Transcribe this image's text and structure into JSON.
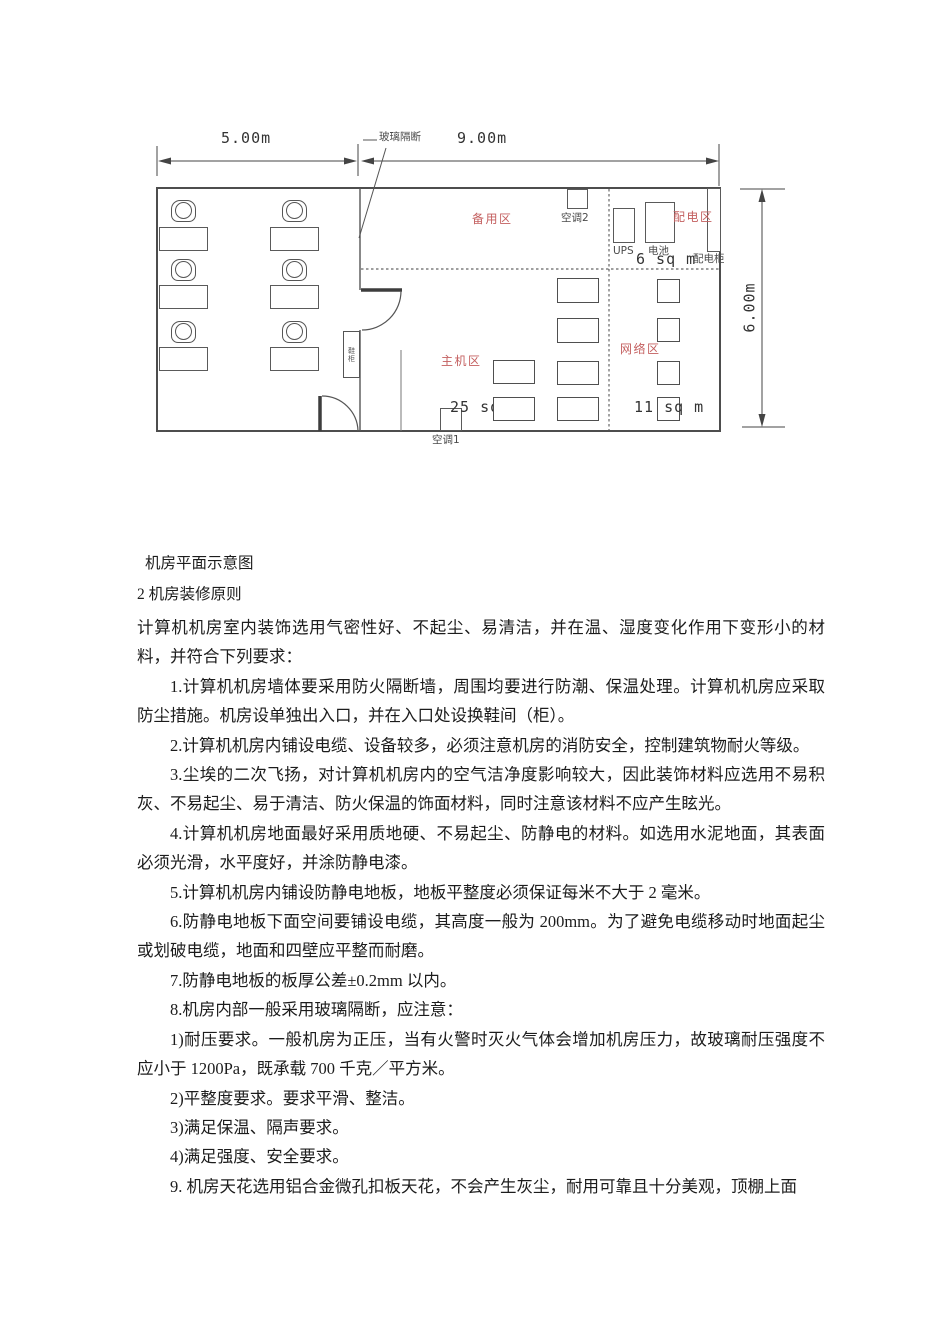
{
  "diagram": {
    "dimensions": {
      "left_width": "5.00m",
      "right_width": "9.00m",
      "height": "6.00m"
    },
    "zones": {
      "backup": "备用区",
      "power": "配电区",
      "main": "主机区",
      "network": "网络区"
    },
    "equipment": {
      "glass_partition": "玻璃隔断",
      "ac2": "空调2",
      "ac1": "空调1",
      "ups": "UPS",
      "battery": "电池",
      "power_cabinet": "配电柜",
      "shoe_cabinet": "鞋柜"
    },
    "areas": {
      "power": "6 sq m",
      "main": "25 sq",
      "network": "11 sq m"
    }
  },
  "content": {
    "caption": "机房平面示意图",
    "heading": "2 机房装修原则",
    "intro": "计算机机房室内装饰选用气密性好、不起尘、易清洁，并在温、湿度变化作用下变形小的材料，并符合下列要求：",
    "paragraphs": [
      "1.计算机机房墙体要采用防火隔断墙，周围均要进行防潮、保温处理。计算机机房应采取防尘措施。机房设单独出入口，并在入口处设换鞋间（柜）。",
      "2.计算机机房内铺设电缆、设备较多，必须注意机房的消防安全，控制建筑物耐火等级。",
      "3.尘埃的二次飞扬，对计算机机房内的空气洁净度影响较大，因此装饰材料应选用不易积灰、不易起尘、易于清洁、防火保温的饰面材料，同时注意该材料不应产生眩光。",
      "4.计算机机房地面最好采用质地硬、不易起尘、防静电的材料。如选用水泥地面，其表面必须光滑，水平度好，并涂防静电漆。",
      "5.计算机机房内铺设防静电地板，地板平整度必须保证每米不大于 2 毫米。",
      "6.防静电地板下面空间要铺设电缆，其高度一般为 200mm。为了避免电缆移动时地面起尘或划破电缆，地面和四壁应平整而耐磨。",
      "7.防静电地板的板厚公差±0.2mm 以内。",
      "8.机房内部一般采用玻璃隔断，应注意：",
      "1)耐压要求。一般机房为正压，当有火警时灭火气体会增加机房压力，故玻璃耐压强度不应小于 1200Pa，既承载 700 千克／平方米。",
      "2)平整度要求。要求平滑、整洁。",
      "3)满足保温、隔声要求。",
      "4)满足强度、安全要求。",
      "9. 机房天花选用铝合金微孔扣板天花，不会产生灰尘，耐用可靠且十分美观，顶棚上面"
    ]
  }
}
